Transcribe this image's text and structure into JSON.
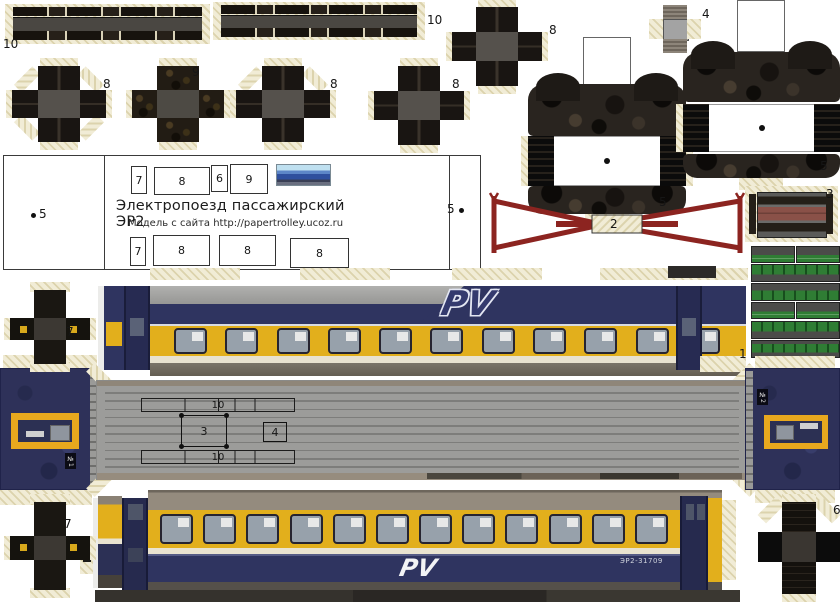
{
  "panel": {
    "title": "Электропоезд пассажирский ЭР2",
    "subtitle": "Модель с сайта  http://papertrolley.ucoz.ru",
    "left_marker": "5",
    "right_marker": "5",
    "top_slots": [
      "7",
      "8",
      "6",
      "9"
    ],
    "bottom_slots": [
      "7",
      "8",
      "8",
      "8"
    ]
  },
  "labels": {
    "strip_a": "10",
    "strip_b": "10",
    "cross_labels": [
      "8",
      "9",
      "8",
      "8",
      "8"
    ],
    "part4": "4",
    "bogie_left": "5",
    "bogie_right": "5",
    "pantograph": "2",
    "part3": "3",
    "car_side": "1",
    "cross7_upper": "7",
    "cross7_lower": "7",
    "cross6": "6"
  },
  "roof": {
    "strip_top": "10",
    "rect3": "3",
    "rect4": "4",
    "strip_bottom": "10"
  },
  "train": {
    "car_number": "ЭР2-31709",
    "cab1_label": "№1",
    "cab2_label": "№2",
    "logo": "PV"
  },
  "colors": {
    "body_yellow": "#e2af1c",
    "body_navy": "#2f3460",
    "roof_gray": "#9c9c9a",
    "pantograph_red": "#8c2420",
    "equipment_green": "#2f7d34",
    "tab_cream": "#f1ecd6"
  },
  "config": {
    "upper_windows": 11,
    "lower_windows": 12,
    "roof_ribs": 10
  }
}
